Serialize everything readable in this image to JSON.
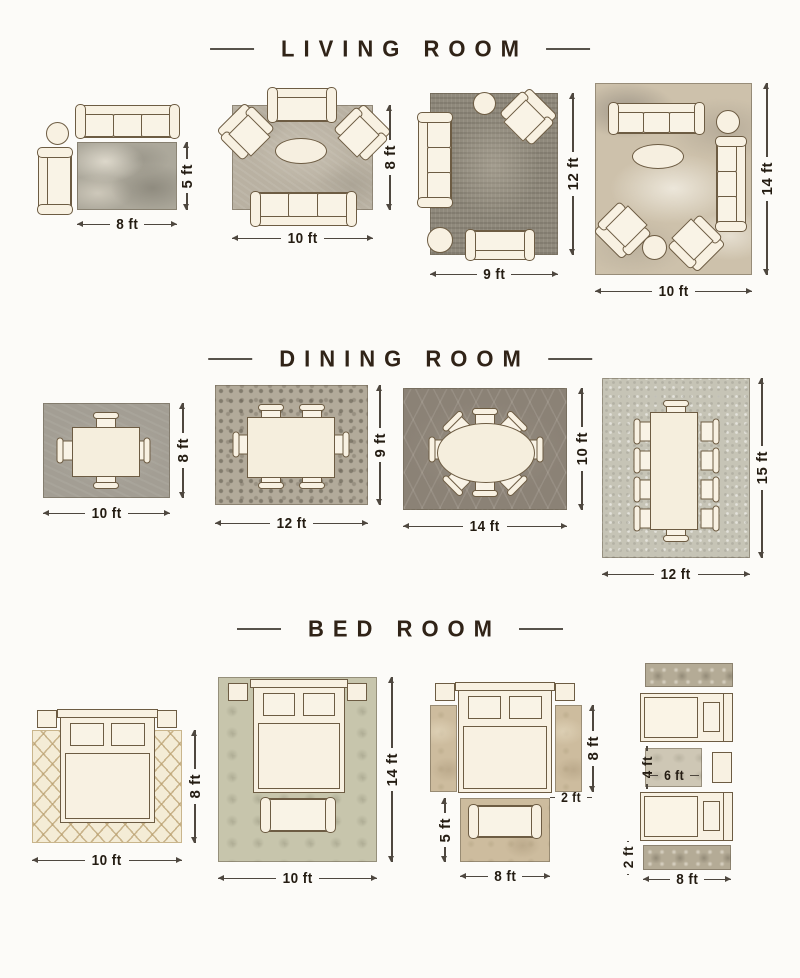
{
  "sections": [
    {
      "title": "LIVING ROOM",
      "layouts": [
        {
          "width": "8 ft",
          "height": "5 ft"
        },
        {
          "width": "10 ft",
          "height": "8 ft"
        },
        {
          "width": "9 ft",
          "height": "12 ft"
        },
        {
          "width": "10 ft",
          "height": "14 ft"
        }
      ]
    },
    {
      "title": "DINING ROOM",
      "layouts": [
        {
          "width": "10 ft",
          "height": "8 ft"
        },
        {
          "width": "12 ft",
          "height": "9 ft"
        },
        {
          "width": "14 ft",
          "height": "10 ft"
        },
        {
          "width": "12 ft",
          "height": "15 ft"
        }
      ]
    },
    {
      "title": "BED ROOM",
      "layouts": [
        {
          "width": "10 ft",
          "height": "8 ft"
        },
        {
          "width": "10 ft",
          "height": "14 ft"
        },
        {
          "width": "8 ft",
          "side": "8 ft",
          "runner": "2 ft",
          "foot": "5 ft"
        },
        {
          "width": "8 ft",
          "runner": "2 ft",
          "accent_w": "6 ft",
          "accent_h": "4 ft"
        }
      ]
    }
  ],
  "colors": {
    "accent_text": "#241c12",
    "title_text": "#302317",
    "furniture_outline": "#6d5c43"
  }
}
